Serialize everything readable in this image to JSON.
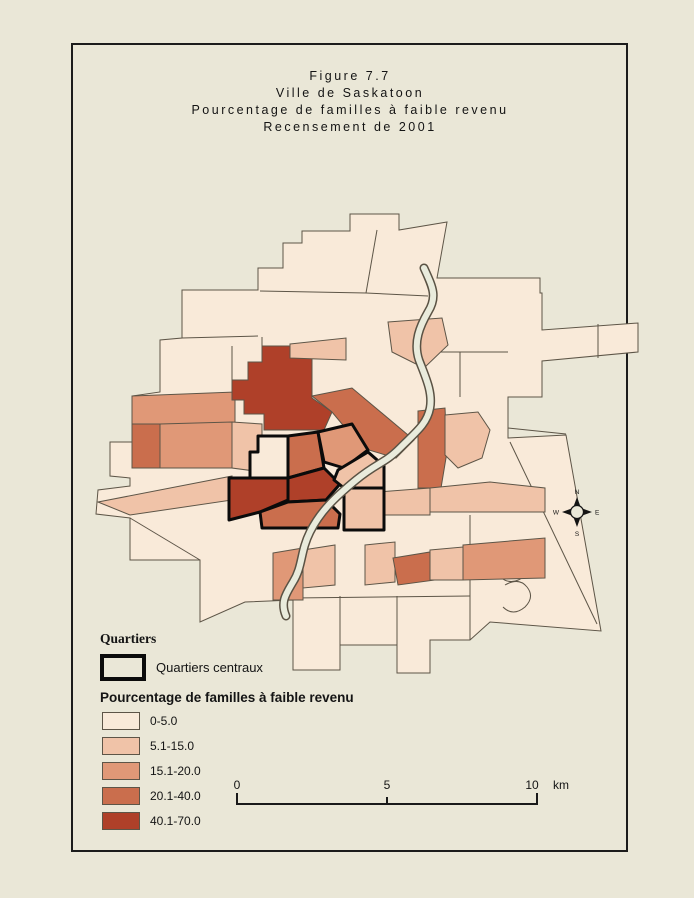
{
  "figure": {
    "title_lines": [
      "Figure 7.7",
      "Ville de Saskatoon",
      "Pourcentage de familles à faible revenu",
      "Recensement de 2001"
    ]
  },
  "legend": {
    "quartiers_heading": "Quartiers",
    "central_outline_label": "Quartiers centraux",
    "choropleth_heading": "Pourcentage de familles à faible revenu",
    "classes": [
      {
        "label": "0-5.0",
        "color": "#f9ead9"
      },
      {
        "label": "5.1-15.0",
        "color": "#f0c3a8"
      },
      {
        "label": "15.1-20.0",
        "color": "#e09877"
      },
      {
        "label": "20.1-40.0",
        "color": "#ca6e4d"
      },
      {
        "label": "40.1-70.0",
        "color": "#af4029"
      }
    ]
  },
  "scale_bar": {
    "tick_labels": [
      "0",
      "5",
      "10"
    ],
    "unit": "km"
  },
  "compass": {
    "north": "N",
    "east": "E",
    "south": "S",
    "west": "W"
  },
  "map": {
    "river_color": "#e9ebdc",
    "outline_color": "#5d5547",
    "central_outline_color": "#0b0b0b",
    "background_color": "#eae7d7"
  }
}
